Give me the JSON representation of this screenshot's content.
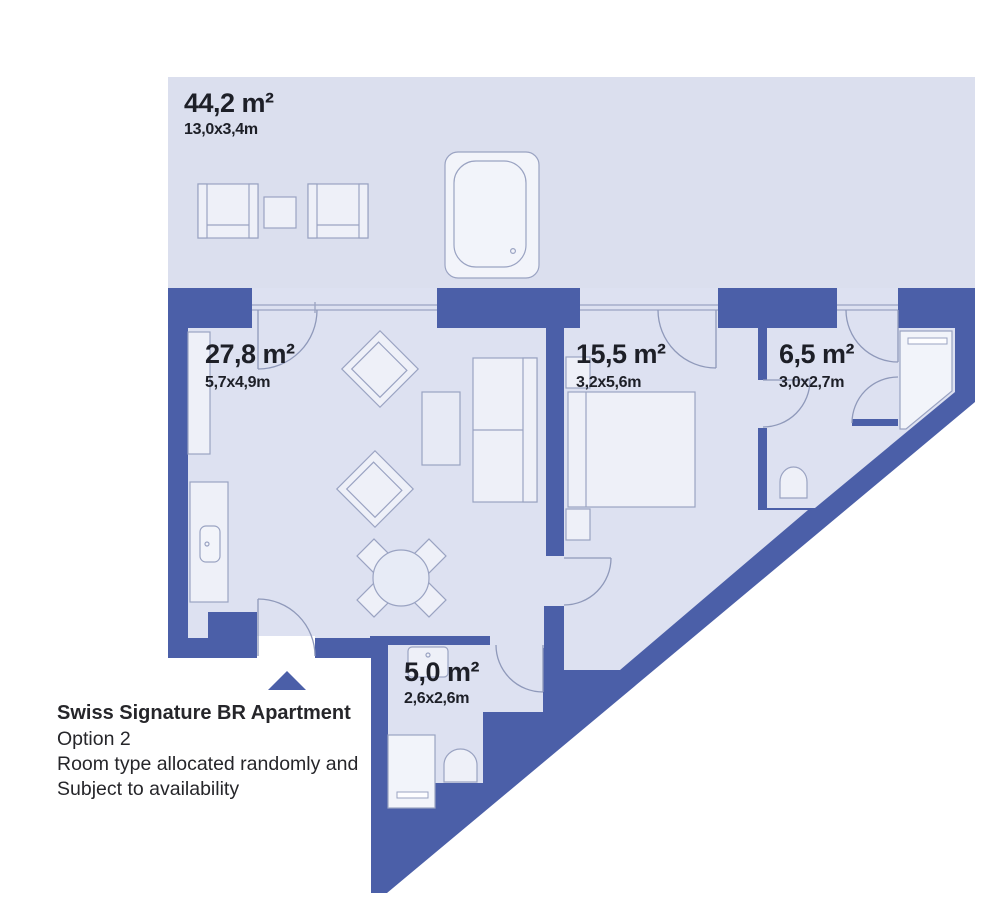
{
  "plan": {
    "colors": {
      "wall": "#4b5fa8",
      "floor": "#dde1f1",
      "terrace": "#dbdfee",
      "fixture": "#eef0f8",
      "fixture_light": "#f2f4fa",
      "outline": "#9aa3c2",
      "text": "#1d1f27"
    },
    "rooms": [
      {
        "id": "terrace",
        "area": "44,2 m²",
        "dims": "13,0x3,4m"
      },
      {
        "id": "living-room",
        "area": "27,8 m²",
        "dims": "5,7x4,9m"
      },
      {
        "id": "bedroom",
        "area": "15,5 m²",
        "dims": "3,2x5,6m"
      },
      {
        "id": "bathroom",
        "area": "6,5 m²",
        "dims": "3,0x2,7m"
      },
      {
        "id": "shower-room",
        "area": "5,0 m²",
        "dims": "2,6x2,6m"
      }
    ],
    "footer": {
      "title": "Swiss Signature BR Apartment",
      "option": "Option 2",
      "note_line1": "Room type allocated randomly and",
      "note_line2": "Subject to availability"
    }
  }
}
